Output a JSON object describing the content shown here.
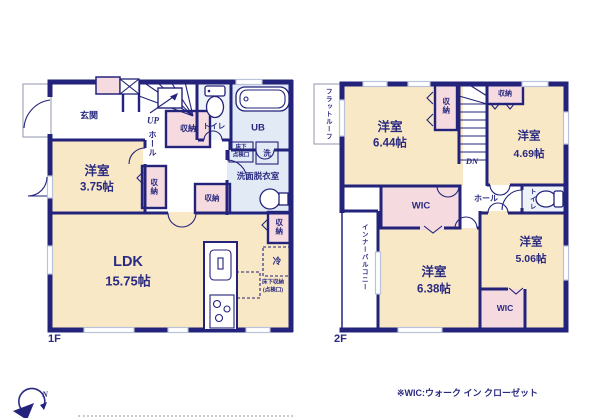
{
  "colors": {
    "wall": "#23237b",
    "text": "#2a2a80",
    "cream": "#f8e8c6",
    "pink": "#f5dbdf",
    "blue": "#e2eaf5",
    "lightblue": "#eef3fa",
    "window": "#b9c2d8",
    "outline": "#9aa0b5"
  },
  "floor1": {
    "label": "1F",
    "entrance": "玄関",
    "up": "UP",
    "hall": "ホール",
    "storage": "収納",
    "toilet": "トイレ",
    "bath": "UB",
    "washroom": "洗面脱衣室",
    "laundry": "洗",
    "hatch_top": "床下",
    "hatch_bottom": "点検口",
    "room": "洋室",
    "room_size": "3.75帖",
    "ldk": "LDK",
    "ldk_size": "15.75帖",
    "fridge": "冷",
    "floor_storage_1": "床下収納",
    "floor_storage_2": "(点検口)"
  },
  "floor2": {
    "label": "2F",
    "flat_roof": "フラットルーフ",
    "dn": "DN",
    "hall": "ホール",
    "storage": "収納",
    "toilet": "トイレ",
    "wic": "WIC",
    "inner_balcony": "インナーバルコニー",
    "room1": "洋室",
    "room1_size": "6.44帖",
    "room2": "洋室",
    "room2_size": "4.69帖",
    "room3": "洋室",
    "room3_size": "6.38帖",
    "room4": "洋室",
    "room4_size": "5.06帖"
  },
  "compass": {
    "north": "N"
  },
  "footer": {
    "note": "※WIC:ウォーク イン クローゼット"
  }
}
